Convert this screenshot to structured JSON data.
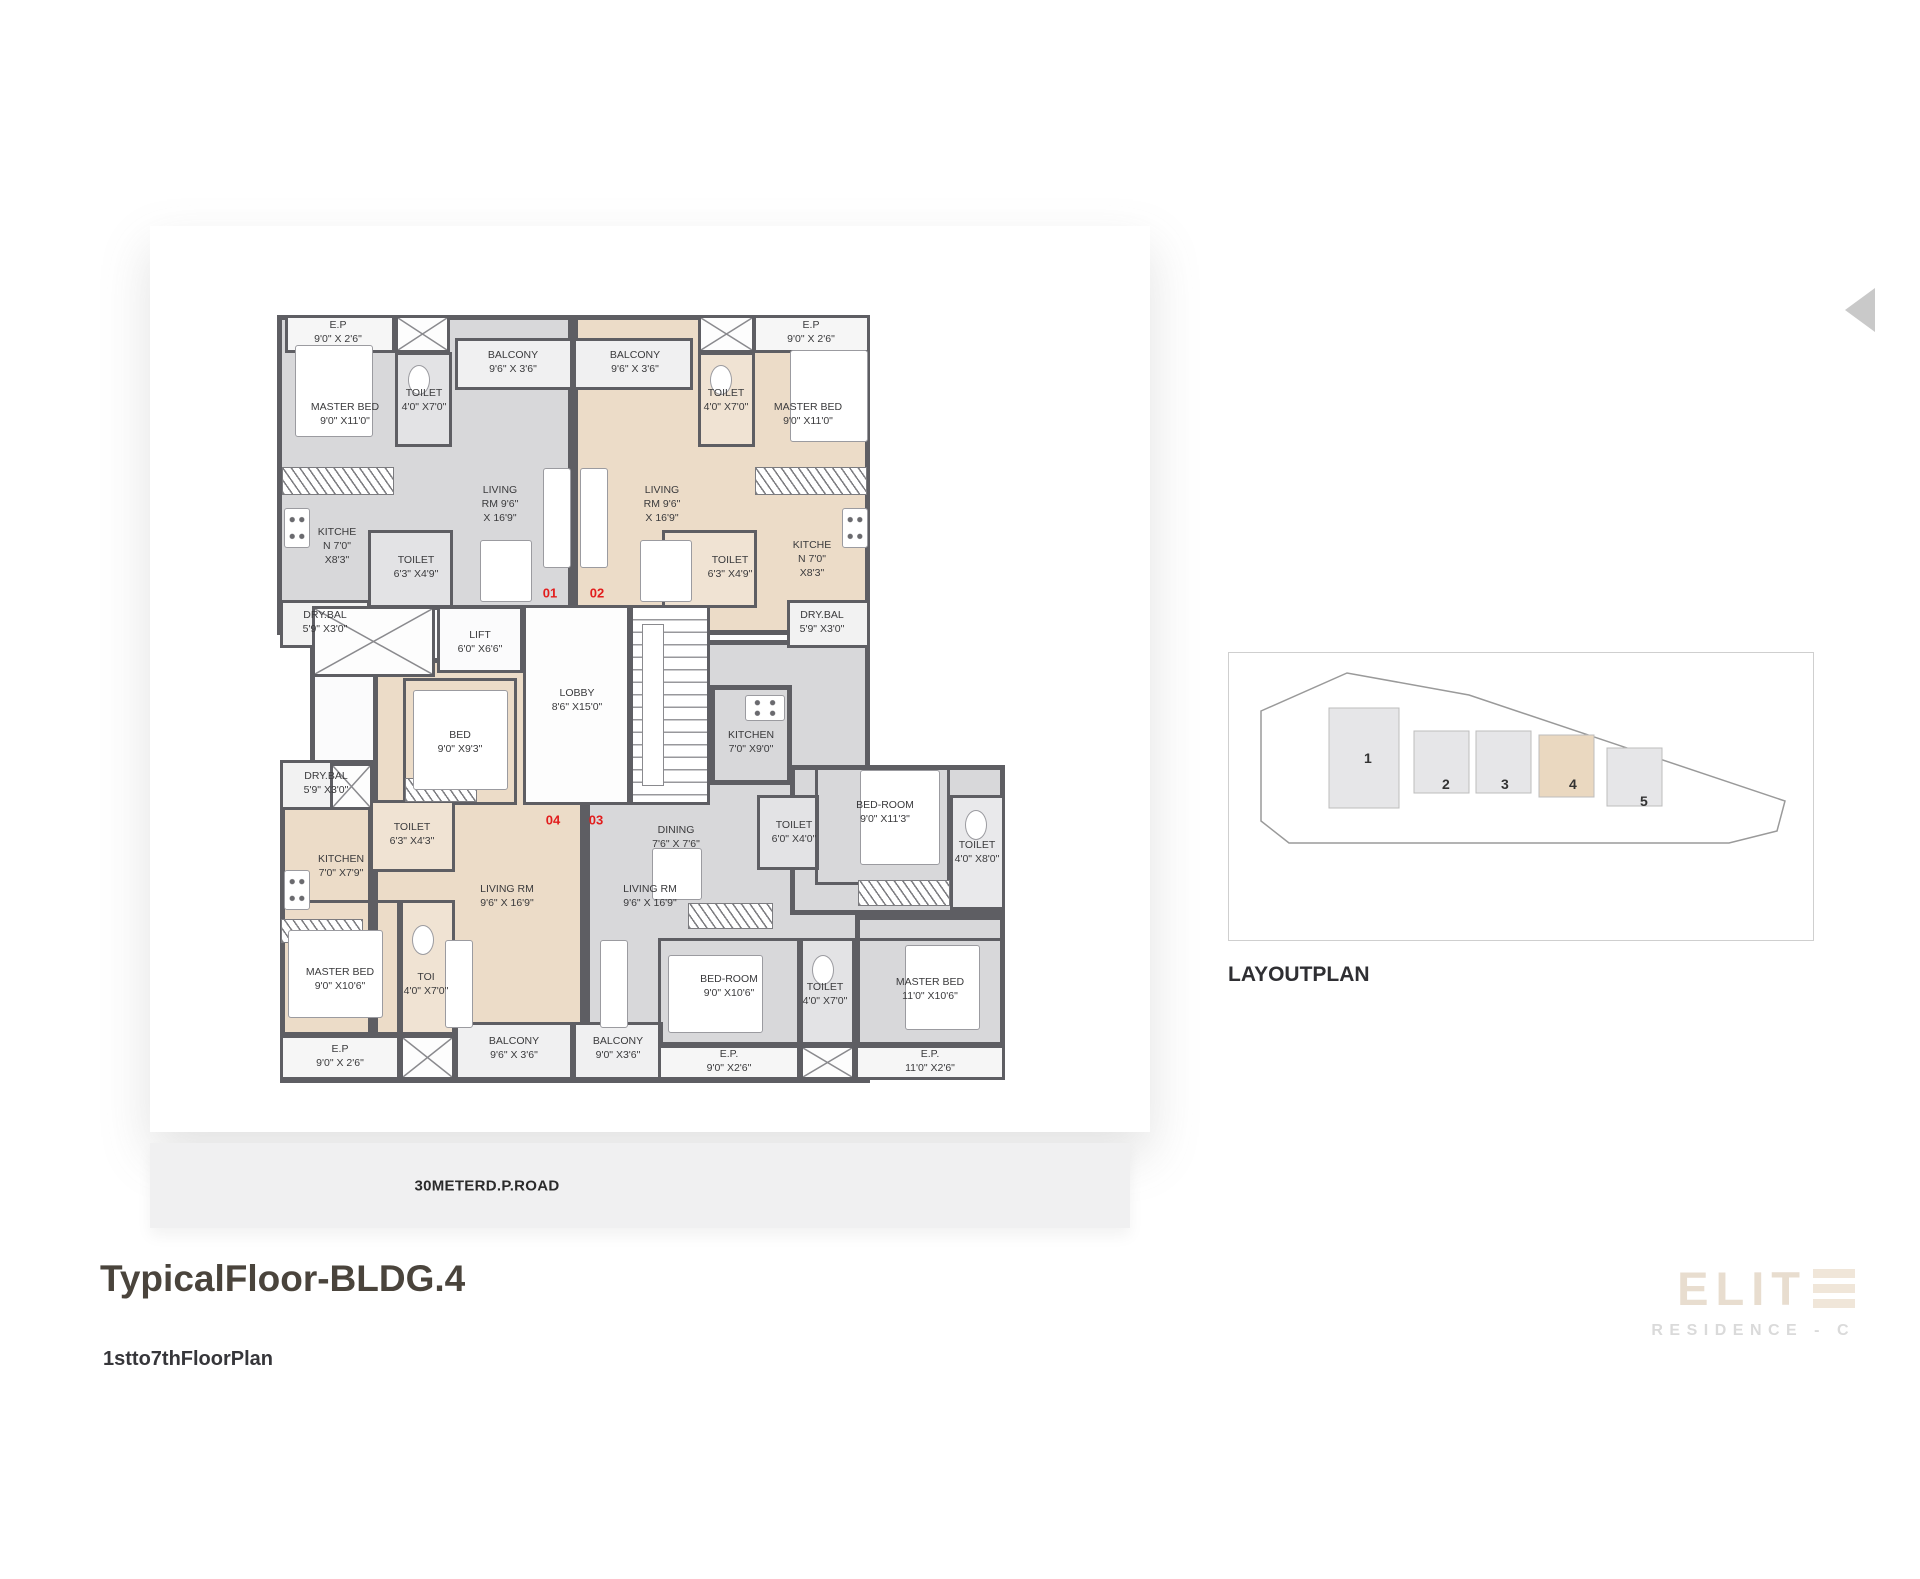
{
  "title": "TypicalFloor-BLDG.4",
  "subtitle": "1stto7thFloorPlan",
  "road_label": "30METERD.P.ROAD",
  "layout_plan": {
    "heading": "LAYOUTPLAN",
    "outline": "32,58 118,20 240,42 556,148 548,178 500,190 60,190 32,168",
    "buildings": [
      {
        "label": "1",
        "x": 100,
        "y": 55,
        "w": 70,
        "h": 100,
        "fill": "#e6e6e8",
        "lx": 135,
        "ly": 110
      },
      {
        "label": "2",
        "x": 185,
        "y": 78,
        "w": 55,
        "h": 62,
        "fill": "#e6e6e8",
        "lx": 213,
        "ly": 136
      },
      {
        "label": "3",
        "x": 247,
        "y": 78,
        "w": 55,
        "h": 62,
        "fill": "#e6e6e8",
        "lx": 272,
        "ly": 136
      },
      {
        "label": "4",
        "x": 310,
        "y": 82,
        "w": 55,
        "h": 62,
        "fill": "#ead8c0",
        "lx": 340,
        "ly": 136
      },
      {
        "label": "5",
        "x": 378,
        "y": 95,
        "w": 55,
        "h": 58,
        "fill": "#e6e6e8",
        "lx": 411,
        "ly": 153
      }
    ]
  },
  "logo": {
    "brand": "ELIT",
    "brand_icon": "triple-bar-e-icon",
    "tagline": "RESIDENCE - C"
  },
  "colors": {
    "wall": "#5e5e63",
    "unit_gray": "#d8d8da",
    "unit_beige": "#ecdcc8",
    "white_room": "#f6f6f6",
    "balcony": "#f0f0f1",
    "toilet_gray": "#e3e3e5",
    "toilet_beige": "#f0e3d3",
    "accent_red": "#e21d1d",
    "brand_beige": "#e8ddcf"
  },
  "floor_plan": {
    "fills": [
      {
        "x": 117,
        "y": 80,
        "w": 296,
        "h": 320,
        "bg": "#d8d8da"
      },
      {
        "x": 413,
        "y": 80,
        "w": 297,
        "h": 320,
        "bg": "#ecdcc8"
      },
      {
        "x": 150,
        "y": 370,
        "w": 400,
        "h": 200,
        "bg": "#fbfbfc"
      },
      {
        "x": 213,
        "y": 423,
        "w": 212,
        "h": 425,
        "bg": "#ecdcc8"
      },
      {
        "x": 120,
        "y": 528,
        "w": 93,
        "h": 320,
        "bg": "#ecdcc8"
      },
      {
        "x": 425,
        "y": 405,
        "w": 285,
        "h": 443,
        "bg": "#d8d8da"
      },
      {
        "x": 550,
        "y": 450,
        "w": 82,
        "h": 100,
        "bg": "#d8d8da"
      },
      {
        "x": 630,
        "y": 530,
        "w": 215,
        "h": 150,
        "bg": "#d8d8da"
      },
      {
        "x": 695,
        "y": 680,
        "w": 150,
        "h": 165,
        "bg": "#d8d8da"
      }
    ],
    "rooms": [
      {
        "x": 125,
        "y": 80,
        "w": 110,
        "h": 38,
        "bg": "#f6f6f6"
      },
      {
        "x": 235,
        "y": 117,
        "w": 57,
        "h": 95,
        "bg": "#e3e3e5"
      },
      {
        "x": 295,
        "y": 103,
        "w": 118,
        "h": 52,
        "bg": "#f0f0f1"
      },
      {
        "x": 413,
        "y": 103,
        "w": 120,
        "h": 52,
        "bg": "#f0f0f1"
      },
      {
        "x": 593,
        "y": 80,
        "w": 117,
        "h": 38,
        "bg": "#f6f6f6"
      },
      {
        "x": 538,
        "y": 117,
        "w": 57,
        "h": 95,
        "bg": "#f0e3d3"
      },
      {
        "x": 208,
        "y": 295,
        "w": 85,
        "h": 78,
        "bg": "#e3e3e5"
      },
      {
        "x": 120,
        "y": 365,
        "w": 90,
        "h": 48,
        "bg": "#f2f2f2"
      },
      {
        "x": 502,
        "y": 295,
        "w": 95,
        "h": 78,
        "bg": "#f0e3d3"
      },
      {
        "x": 627,
        "y": 365,
        "w": 83,
        "h": 48,
        "bg": "#f2f2f2"
      },
      {
        "x": 277,
        "y": 371,
        "w": 86,
        "h": 67,
        "bg": "#fbfbfc"
      },
      {
        "x": 363,
        "y": 370,
        "w": 107,
        "h": 200,
        "bg": "#fdfdfd"
      },
      {
        "x": 243,
        "y": 443,
        "w": 114,
        "h": 127,
        "bg": "transparent"
      },
      {
        "x": 120,
        "y": 525,
        "w": 93,
        "h": 50,
        "bg": "#f2f2f2"
      },
      {
        "x": 210,
        "y": 565,
        "w": 85,
        "h": 72,
        "bg": "#f0e3d3"
      },
      {
        "x": 120,
        "y": 665,
        "w": 120,
        "h": 135,
        "bg": "transparent"
      },
      {
        "x": 240,
        "y": 665,
        "w": 55,
        "h": 135,
        "bg": "#f0e3d3"
      },
      {
        "x": 120,
        "y": 800,
        "w": 120,
        "h": 45,
        "bg": "#f6f6f6"
      },
      {
        "x": 295,
        "y": 787,
        "w": 118,
        "h": 58,
        "bg": "#f0f0f1"
      },
      {
        "x": 413,
        "y": 787,
        "w": 90,
        "h": 58,
        "bg": "#f0f0f1"
      },
      {
        "x": 597,
        "y": 560,
        "w": 62,
        "h": 75,
        "bg": "#e3e3e5"
      },
      {
        "x": 655,
        "y": 530,
        "w": 135,
        "h": 120,
        "bg": "transparent"
      },
      {
        "x": 790,
        "y": 560,
        "w": 55,
        "h": 115,
        "bg": "#e9e9eb"
      },
      {
        "x": 498,
        "y": 703,
        "w": 142,
        "h": 107,
        "bg": "transparent"
      },
      {
        "x": 640,
        "y": 703,
        "w": 55,
        "h": 107,
        "bg": "#e3e3e5"
      },
      {
        "x": 695,
        "y": 703,
        "w": 150,
        "h": 107,
        "bg": "transparent"
      },
      {
        "x": 498,
        "y": 810,
        "w": 142,
        "h": 35,
        "bg": "#f6f6f6"
      },
      {
        "x": 695,
        "y": 810,
        "w": 150,
        "h": 35,
        "bg": "#f6f6f6"
      }
    ],
    "xboxes": [
      {
        "x": 235,
        "y": 80,
        "w": 55,
        "h": 38
      },
      {
        "x": 538,
        "y": 80,
        "w": 57,
        "h": 38
      },
      {
        "x": 152,
        "y": 371,
        "w": 123,
        "h": 71
      },
      {
        "x": 170,
        "y": 528,
        "w": 43,
        "h": 47
      },
      {
        "x": 240,
        "y": 800,
        "w": 55,
        "h": 45
      },
      {
        "x": 640,
        "y": 810,
        "w": 55,
        "h": 35
      }
    ],
    "stairs": {
      "x": 470,
      "y": 370,
      "w": 80,
      "h": 200
    },
    "hatches": [
      {
        "x": 122,
        "y": 232,
        "w": 112,
        "h": 28
      },
      {
        "x": 595,
        "y": 232,
        "w": 112,
        "h": 28
      },
      {
        "x": 528,
        "y": 668,
        "w": 85,
        "h": 26
      },
      {
        "x": 698,
        "y": 645,
        "w": 92,
        "h": 26
      },
      {
        "x": 121,
        "y": 684,
        "w": 82,
        "h": 24
      },
      {
        "x": 245,
        "y": 543,
        "w": 72,
        "h": 24
      }
    ],
    "furniture": [
      {
        "t": "rect",
        "x": 135,
        "y": 110,
        "w": 78,
        "h": 92
      },
      {
        "t": "rect",
        "x": 630,
        "y": 115,
        "w": 78,
        "h": 92
      },
      {
        "t": "rect",
        "x": 253,
        "y": 455,
        "w": 95,
        "h": 100
      },
      {
        "t": "rect",
        "x": 128,
        "y": 695,
        "w": 95,
        "h": 88
      },
      {
        "t": "rect",
        "x": 700,
        "y": 535,
        "w": 80,
        "h": 95
      },
      {
        "t": "rect",
        "x": 508,
        "y": 720,
        "w": 95,
        "h": 78
      },
      {
        "t": "rect",
        "x": 745,
        "y": 710,
        "w": 75,
        "h": 85
      },
      {
        "t": "rect",
        "x": 320,
        "y": 305,
        "w": 52,
        "h": 62
      },
      {
        "t": "rect",
        "x": 480,
        "y": 305,
        "w": 52,
        "h": 62
      },
      {
        "t": "rect",
        "x": 492,
        "y": 613,
        "w": 50,
        "h": 52
      },
      {
        "t": "rect",
        "x": 383,
        "y": 233,
        "w": 28,
        "h": 100
      },
      {
        "t": "rect",
        "x": 420,
        "y": 233,
        "w": 28,
        "h": 100
      },
      {
        "t": "rect",
        "x": 285,
        "y": 705,
        "w": 28,
        "h": 88
      },
      {
        "t": "rect",
        "x": 440,
        "y": 705,
        "w": 28,
        "h": 88
      },
      {
        "t": "stove",
        "x": 124,
        "y": 273,
        "w": 26,
        "h": 40
      },
      {
        "t": "stove",
        "x": 682,
        "y": 273,
        "w": 26,
        "h": 40
      },
      {
        "t": "stove",
        "x": 124,
        "y": 635,
        "w": 26,
        "h": 40
      },
      {
        "t": "stove",
        "x": 585,
        "y": 460,
        "w": 40,
        "h": 26
      },
      {
        "t": "ell",
        "x": 248,
        "y": 130,
        "w": 22,
        "h": 30
      },
      {
        "t": "ell",
        "x": 550,
        "y": 130,
        "w": 22,
        "h": 30
      },
      {
        "t": "ell",
        "x": 805,
        "y": 575,
        "w": 22,
        "h": 30
      },
      {
        "t": "ell",
        "x": 252,
        "y": 690,
        "w": 22,
        "h": 30
      },
      {
        "t": "ell",
        "x": 652,
        "y": 720,
        "w": 22,
        "h": 30
      }
    ],
    "labels": [
      {
        "x": 178,
        "y": 98,
        "lines": [
          "E.P",
          "9'0\" X 2'6\""
        ]
      },
      {
        "x": 185,
        "y": 180,
        "lines": [
          "MASTER BED",
          "9'0\" X11'0\""
        ]
      },
      {
        "x": 264,
        "y": 166,
        "lines": [
          "TOILET",
          "4'0\" X7'0\""
        ]
      },
      {
        "x": 353,
        "y": 128,
        "lines": [
          "BALCONY",
          "9'6\" X 3'6\""
        ]
      },
      {
        "x": 340,
        "y": 270,
        "lines": [
          "LIVING",
          "RM   9'6\"",
          "X 16'9\""
        ]
      },
      {
        "x": 177,
        "y": 312,
        "lines": [
          "KITCHE",
          "N   7'0\"",
          "X8'3\""
        ]
      },
      {
        "x": 256,
        "y": 333,
        "lines": [
          "TOILET",
          "6'3\" X4'9\""
        ]
      },
      {
        "x": 165,
        "y": 388,
        "lines": [
          "DRY.BAL",
          "5'9\" X3'0\""
        ]
      },
      {
        "x": 651,
        "y": 98,
        "lines": [
          "E.P",
          "9'0\" X 2'6\""
        ]
      },
      {
        "x": 648,
        "y": 180,
        "lines": [
          "MASTER BED",
          "9'0\" X11'0\""
        ]
      },
      {
        "x": 566,
        "y": 166,
        "lines": [
          "TOILET",
          "4'0\" X7'0\""
        ]
      },
      {
        "x": 475,
        "y": 128,
        "lines": [
          "BALCONY",
          "9'6\" X 3'6\""
        ]
      },
      {
        "x": 502,
        "y": 270,
        "lines": [
          "LIVING",
          "RM   9'6\"",
          "X 16'9\""
        ]
      },
      {
        "x": 652,
        "y": 325,
        "lines": [
          "KITCHE",
          "N   7'0\"",
          "X8'3\""
        ]
      },
      {
        "x": 570,
        "y": 333,
        "lines": [
          "TOILET",
          "6'3\" X4'9\""
        ]
      },
      {
        "x": 662,
        "y": 388,
        "lines": [
          "DRY.BAL",
          "5'9\" X3'0\""
        ]
      },
      {
        "x": 320,
        "y": 408,
        "lines": [
          "LIFT",
          "6'0\" X6'6\""
        ]
      },
      {
        "x": 417,
        "y": 466,
        "lines": [
          "LOBBY",
          "8'6\" X15'0\""
        ]
      },
      {
        "x": 300,
        "y": 508,
        "lines": [
          "BED",
          "9'0\" X9'3\""
        ]
      },
      {
        "x": 166,
        "y": 549,
        "lines": [
          "DRY.BAL",
          "5'9\" X3'0\""
        ]
      },
      {
        "x": 181,
        "y": 632,
        "lines": [
          "KITCHEN",
          "7'0\" X7'9\""
        ]
      },
      {
        "x": 252,
        "y": 600,
        "lines": [
          "TOILET",
          "6'3\" X4'3\""
        ]
      },
      {
        "x": 347,
        "y": 662,
        "lines": [
          "LIVING RM",
          "9'6\" X 16'9\""
        ]
      },
      {
        "x": 180,
        "y": 745,
        "lines": [
          "MASTER BED",
          "9'0\" X10'6\""
        ]
      },
      {
        "x": 266,
        "y": 750,
        "lines": [
          "TOI",
          "4'0\" X7'0\""
        ]
      },
      {
        "x": 180,
        "y": 822,
        "lines": [
          "E.P",
          "9'0\" X 2'6\""
        ]
      },
      {
        "x": 354,
        "y": 814,
        "lines": [
          "BALCONY",
          "9'6\" X 3'6\""
        ]
      },
      {
        "x": 591,
        "y": 508,
        "lines": [
          "KITCHEN",
          "7'0\" X9'0\""
        ]
      },
      {
        "x": 516,
        "y": 603,
        "lines": [
          "DINING",
          "7'6\" X 7'6\""
        ]
      },
      {
        "x": 490,
        "y": 662,
        "lines": [
          "LIVING RM",
          "9'6\" X 16'9\""
        ]
      },
      {
        "x": 634,
        "y": 598,
        "lines": [
          "TOILET",
          "6'0\" X4'0\""
        ]
      },
      {
        "x": 725,
        "y": 578,
        "lines": [
          "BED-ROOM",
          "9'0\" X11'3\""
        ]
      },
      {
        "x": 817,
        "y": 618,
        "lines": [
          "TOILET",
          "4'0\" X8'0\""
        ]
      },
      {
        "x": 569,
        "y": 752,
        "lines": [
          "BED-ROOM",
          "9'0\" X10'6\""
        ]
      },
      {
        "x": 665,
        "y": 760,
        "lines": [
          "TOILET",
          "4'0\" X7'0\""
        ]
      },
      {
        "x": 770,
        "y": 755,
        "lines": [
          "MASTER BED",
          "11'0\" X10'6\""
        ]
      },
      {
        "x": 569,
        "y": 827,
        "lines": [
          "E.P.",
          "9'0\" X2'6\""
        ]
      },
      {
        "x": 770,
        "y": 827,
        "lines": [
          "E.P.",
          "11'0\" X2'6\""
        ]
      },
      {
        "x": 458,
        "y": 814,
        "lines": [
          "BALCONY",
          "9'0\" X3'6\""
        ]
      }
    ],
    "units": [
      {
        "label": "01",
        "x": 390,
        "y": 358
      },
      {
        "label": "02",
        "x": 437,
        "y": 358
      },
      {
        "label": "04",
        "x": 393,
        "y": 585
      },
      {
        "label": "03",
        "x": 436,
        "y": 585
      }
    ]
  }
}
